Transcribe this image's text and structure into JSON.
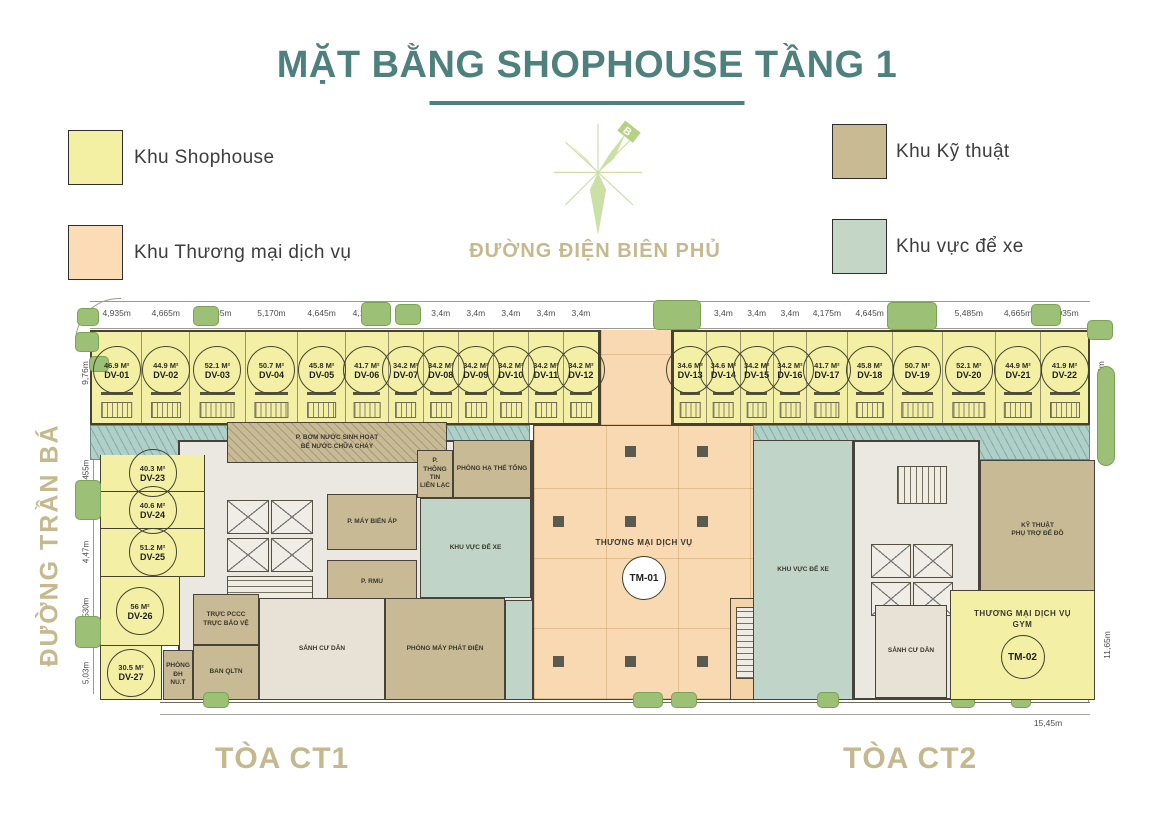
{
  "title": "MẶT BẰNG SHOPHOUSE TẦNG 1",
  "legend": {
    "shophouse": {
      "label": "Khu Shophouse",
      "color": "#f4f0a3"
    },
    "commercial": {
      "label": "Khu Thương mại dịch vụ",
      "color": "#fbdcb6"
    },
    "technical": {
      "label": "Khu Kỹ thuật",
      "color": "#c8ba93"
    },
    "parking": {
      "label": "Khu vực để xe",
      "color": "#c4d7c6"
    }
  },
  "compass": {
    "north_label": "B"
  },
  "streets": {
    "top": "ĐƯỜNG ĐIỆN BIÊN PHỦ",
    "left": "ĐƯỜNG TRẦN BÁ"
  },
  "towers": {
    "ct1": "TÒA CT1",
    "ct2": "TÒA CT2"
  },
  "top_units": [
    {
      "id": "DV-01",
      "area": "46.9 M²",
      "dim": "4,935m",
      "w": 4.935
    },
    {
      "id": "DV-02",
      "area": "44.9 M²",
      "dim": "4,665m",
      "w": 4.665
    },
    {
      "id": "DV-03",
      "area": "52.1 M²",
      "dim": "5,435m",
      "w": 5.435
    },
    {
      "id": "DV-04",
      "area": "50.7 M²",
      "dim": "5,170m",
      "w": 5.17
    },
    {
      "id": "DV-05",
      "area": "45.8 M²",
      "dim": "4,645m",
      "w": 4.645
    },
    {
      "id": "DV-06",
      "area": "41.7 M²",
      "dim": "4,175m",
      "w": 4.175
    },
    {
      "id": "DV-07",
      "area": "34.2 M²",
      "dim": "3,4m",
      "w": 3.4
    },
    {
      "id": "DV-08",
      "area": "34.2 M²",
      "dim": "3,4m",
      "w": 3.4
    },
    {
      "id": "DV-09",
      "area": "34.2 M²",
      "dim": "3,4m",
      "w": 3.4
    },
    {
      "id": "DV-10",
      "area": "34.2 M²",
      "dim": "3,4m",
      "w": 3.4
    },
    {
      "id": "DV-11",
      "area": "34.2 M²",
      "dim": "3,4m",
      "w": 3.4
    },
    {
      "id": "DV-12",
      "area": "34.2 M²",
      "dim": "3,4m",
      "w": 3.4
    }
  ],
  "right_units": [
    {
      "id": "DV-13",
      "area": "34.6 M²",
      "dim": "3,4m",
      "w": 3.4
    },
    {
      "id": "DV-14",
      "area": "34.6 M²",
      "dim": "3,4m",
      "w": 3.4
    },
    {
      "id": "DV-15",
      "area": "34.2 M²",
      "dim": "3,4m",
      "w": 3.4
    },
    {
      "id": "DV-16",
      "area": "34.2 M²",
      "dim": "3,4m",
      "w": 3.4
    },
    {
      "id": "DV-17",
      "area": "41.7 M²",
      "dim": "4,175m",
      "w": 4.175
    },
    {
      "id": "DV-18",
      "area": "45.8 M²",
      "dim": "4,645m",
      "w": 4.645
    },
    {
      "id": "DV-19",
      "area": "50.7 M²",
      "dim": "5,170m",
      "w": 5.17
    },
    {
      "id": "DV-20",
      "area": "52.1 M²",
      "dim": "5,485m",
      "w": 5.485
    },
    {
      "id": "DV-21",
      "area": "44.9 M²",
      "dim": "4,665m",
      "w": 4.665
    },
    {
      "id": "DV-22",
      "area": "41.9 M²",
      "dim": "4,935m",
      "w": 4.935
    }
  ],
  "left_units": [
    {
      "id": "DV-23",
      "area": "40.3 M²",
      "dim": "3,455m",
      "w": 3.455
    },
    {
      "id": "DV-24",
      "area": "40.6 M²",
      "dim": "3,4m",
      "w": 3.4
    },
    {
      "id": "DV-25",
      "area": "51.2 M²",
      "dim": "4,47m",
      "w": 4.47
    },
    {
      "id": "DV-26",
      "area": "56 M²",
      "dim": "6,530m",
      "w": 6.53,
      "wd": 80
    },
    {
      "id": "DV-27",
      "area": "30.5 M²",
      "dim": "5,03m",
      "w": 5.03,
      "wd": 62
    }
  ],
  "commercial_zones": {
    "tm01": {
      "label": "THƯƠNG MẠI DỊCH VỤ",
      "id": "TM-01"
    },
    "tm02": {
      "label": "THƯƠNG MẠI DỊCH VỤ",
      "sublabel": "GYM",
      "id": "TM-02"
    }
  },
  "rooms": {
    "pump_1": "P. BƠM NƯỚC SINH HOẠT",
    "pump_2": "BỂ NƯỚC CHỮA CHÁY",
    "ha_the": "PHÒNG HẠ THẾ TỔNG",
    "thong_tin_1": "P. THÔNG TIN",
    "thong_tin_2": "LIÊN LẠC",
    "bien_ap": "P. MÁY BIẾN ÁP",
    "rmu": "P. RMU",
    "parking_ct1": "KHU VỰC ĐỂ XE",
    "parking_ct2": "KHU VỰC ĐỂ XE",
    "pccc_1": "TRỰC PCCC",
    "pccc_2": "TRỰC BẢO VỆ",
    "qltn": "BAN QLTN",
    "dh_1": "PHÒNG ĐH",
    "dh_2": "NU.T",
    "sanh_ct1": "SẢNH CƯ DÂN",
    "may_phat": "PHÒNG MÁY PHÁT ĐIỆN",
    "ky_thuat_1": "KỸ THUẬT",
    "ky_thuat_2": "PHỤ TRỢ ĐỂ ĐỒ",
    "sanh_ct2": "SẢNH CƯ DÂN",
    "stairs_up": "THANG LÊN TẦNG TRÊN"
  },
  "dimensions": {
    "left_top": "9,76m",
    "right_top": "9,76m",
    "right_bottom": "11,65m",
    "bottom_right": "15,45m"
  }
}
